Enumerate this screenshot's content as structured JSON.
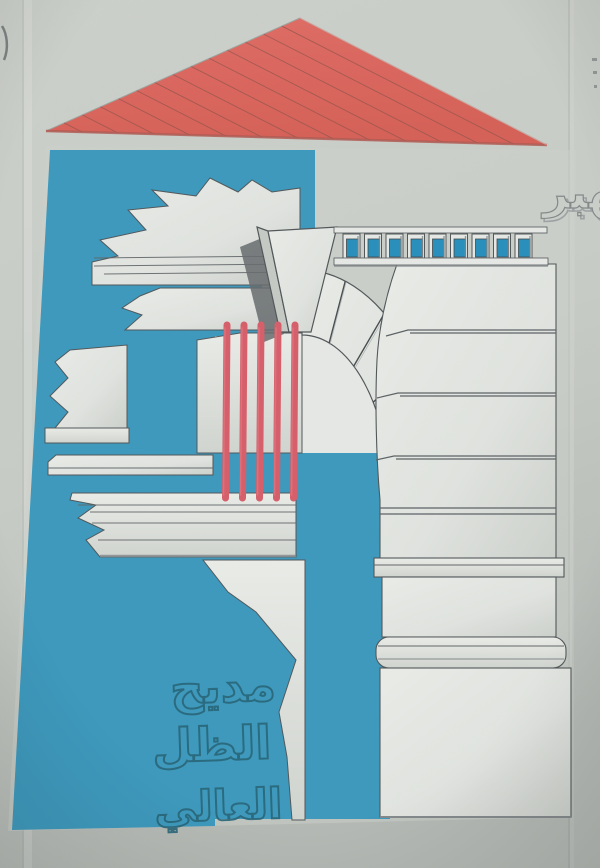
{
  "photo": {
    "subject": "album-cover-poster",
    "artist_name": "خالد الهبر",
    "album_title": "مديح الظل العالي",
    "title_words": [
      "مديح",
      "الظل",
      "العالي"
    ],
    "counts": {
      "strings": 5,
      "dentils": 9,
      "roof_hatch_lines": 13,
      "arch_voussoir_joints": 4
    },
    "colors": {
      "background": "#c8ccc6",
      "background_dark": "#b4b9b5",
      "poster_blue": "#2b93bc",
      "roof_red": "#df584d",
      "roof_hatch": "#8a463c",
      "string_red": "#d8525f",
      "stone_white": "#e9ece8",
      "stone_shade": "#c3c7c2",
      "outline_grey": "#43484c",
      "dentil_blue": "#1488ba",
      "title_outline_blue": "#14596f",
      "emboss_grey": "#82878a"
    }
  }
}
